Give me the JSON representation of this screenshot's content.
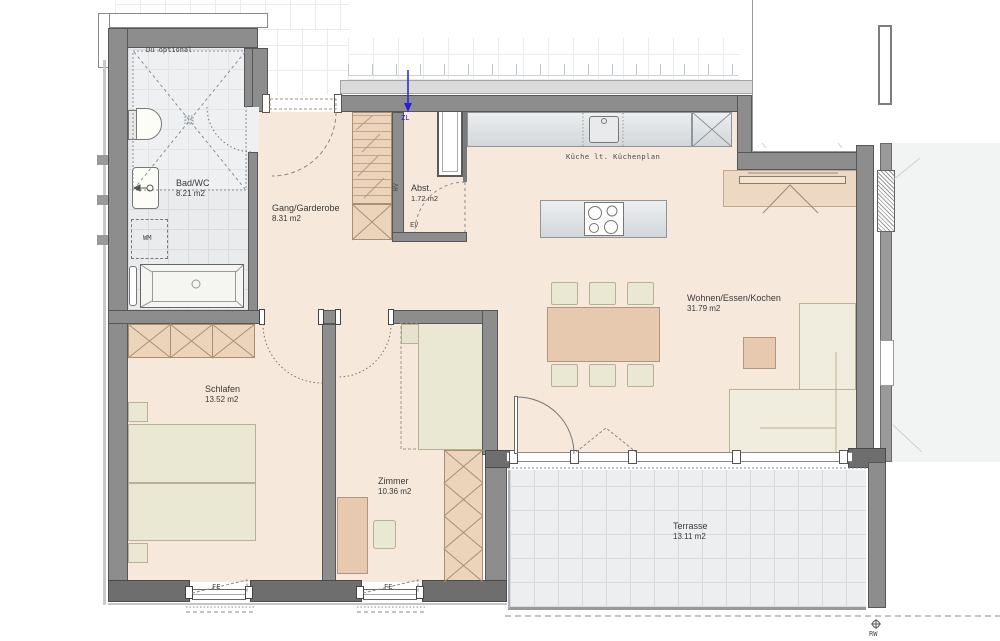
{
  "plan": {
    "title": "apartment-floor-plan",
    "rooms": {
      "bad": {
        "name": "Bad/WC",
        "area": "8.21 m2"
      },
      "gang": {
        "name": "Gang/Garderobe",
        "area": "8.31 m2"
      },
      "abst": {
        "name": "Abst.",
        "area": "1.72 m2"
      },
      "wohnen": {
        "name": "Wohnen/Essen/Kochen",
        "area": "31.79 m2"
      },
      "schlafen": {
        "name": "Schlafen",
        "area": "13.52 m2"
      },
      "zimmer": {
        "name": "Zimmer",
        "area": "10.36 m2"
      },
      "terrasse": {
        "name": "Terrasse",
        "area": "13.11 m2"
      }
    },
    "annotations": {
      "du_optional": "Du optional",
      "kueche": "Küche lt. Küchenplan",
      "wm": "WM",
      "hv": "HV",
      "ev": "EV",
      "zl": "ZL",
      "rw": "RW",
      "fe_window_1": "FE",
      "fe_window_2": "FE",
      "bathtub_size": "180/80"
    },
    "colors": {
      "wall_gray": "#8d8d8d",
      "wall_dark": "#6e6e6e",
      "floor_beige": "#f6e8da",
      "tile_gray": "#e9ebed",
      "furniture_tan": "#ecd4bc",
      "furniture_cream": "#eae7d2",
      "supply_air_blue": "#2323d6"
    }
  }
}
